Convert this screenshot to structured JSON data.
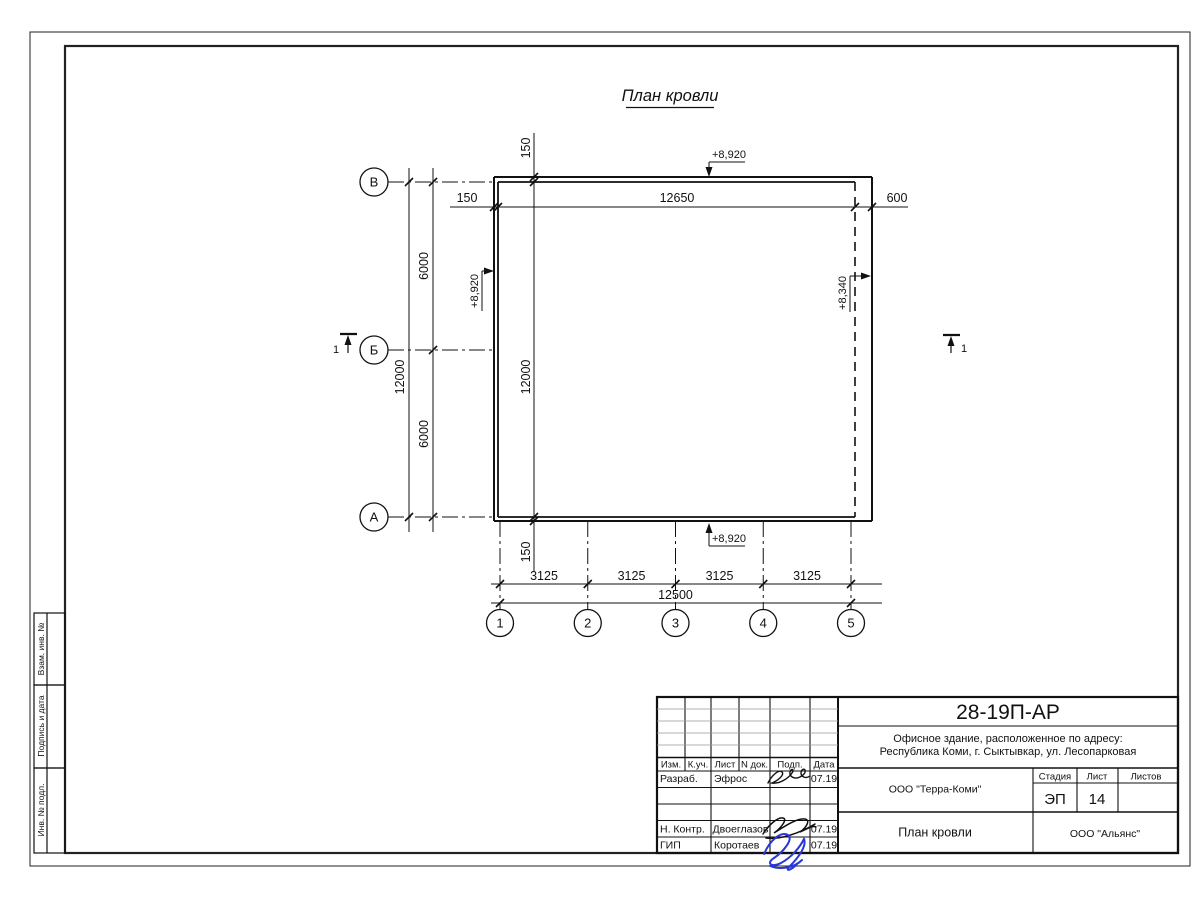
{
  "sheet": {
    "title": "План кровли"
  },
  "plan": {
    "row_axes": [
      "В",
      "Б",
      "А"
    ],
    "col_axes": [
      "1",
      "2",
      "3",
      "4",
      "5"
    ],
    "dims": {
      "top_overhang": "150",
      "top_span": "12650",
      "top_right": "600",
      "left_total": "12000",
      "left_seg_1": "6000",
      "left_seg_2": "6000",
      "inner_top": "150",
      "inner_span": "12000",
      "inner_bottom": "150",
      "bottom_segs": [
        "3125",
        "3125",
        "3125",
        "3125"
      ],
      "bottom_total": "12500"
    },
    "elevations": {
      "top": "+8,920",
      "left": "+8,920",
      "right": "+8,340",
      "bottom": "+8,920"
    },
    "sections": {
      "left": "1",
      "right": "1"
    }
  },
  "margin": {
    "labels": [
      "Взам. инв. №",
      "Подпись и дата",
      "Инв. № подл."
    ]
  },
  "title_block": {
    "doc_number": "28-19П-АР",
    "object_address_line1": "Офисное здание, расположенное по адресу:",
    "object_address_line2": "Республика Коми, г. Сыктывкар, ул. Лесопарковая",
    "header": [
      "Изм.",
      "К.уч.",
      "Лист",
      "N док.",
      "Подп.",
      "Дата"
    ],
    "rows": [
      {
        "role": "Разраб.",
        "name": "Эфрос",
        "date": "07.19"
      },
      {
        "role": "Н. Контр.",
        "name": "Двоеглазов",
        "date": "07.19"
      },
      {
        "role": "ГИП",
        "name": "Коротаев",
        "date": "07.19"
      }
    ],
    "designer": "ООО \"Терра-Коми\"",
    "stage_label": "Стадия",
    "sheet_label": "Лист",
    "sheets_label": "Листов",
    "stage": "ЭП",
    "sheet_number": "14",
    "sheets_total": "",
    "sheet_title": "План кровли",
    "contractor": "ООО \"Альянс\"",
    "accent_blue": "#2936d8"
  }
}
